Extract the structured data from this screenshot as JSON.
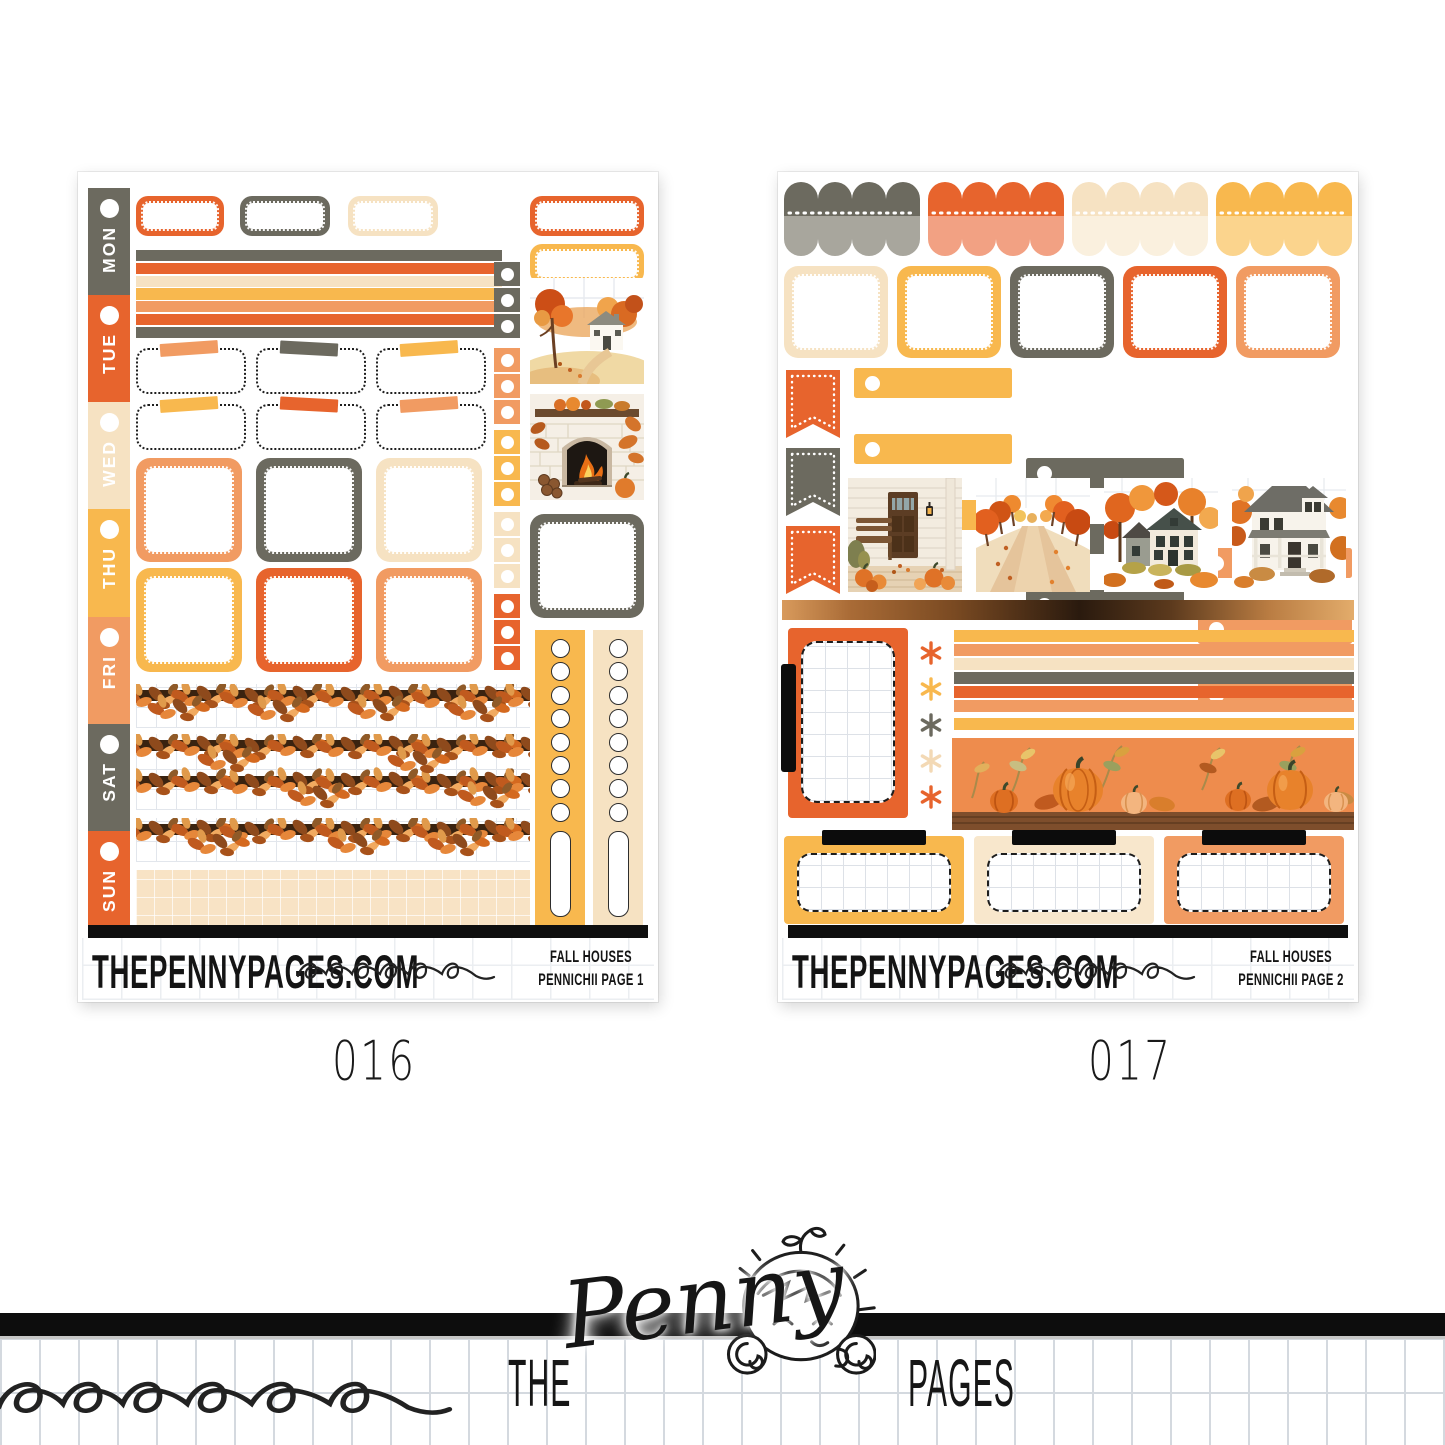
{
  "photo": {
    "background": "#ffffff"
  },
  "brand": {
    "site": "THEPENNYPAGES.COM",
    "kit_name": "FALL HOUSES",
    "logo_word_1": "THE",
    "logo_word_2": "Penny",
    "logo_word_3": "PAGES"
  },
  "sheets": [
    {
      "code": "016",
      "site": "THEPENNYPAGES.COM",
      "kit_line_1": "FALL HOUSES",
      "kit_line_2": "PENNICHII PAGE 1",
      "days": [
        "MON",
        "TUE",
        "WED",
        "THU",
        "FRI",
        "SAT",
        "SUN"
      ]
    },
    {
      "code": "017",
      "site": "THEPENNYPAGES.COM",
      "kit_line_1": "FALL HOUSES",
      "kit_line_2": "PENNICHII PAGE 2"
    }
  ],
  "palette": {
    "orange": "#E7642D",
    "salmon": "#F19B62",
    "salmon_light": "#F2A183",
    "cream": "#F6E2C2",
    "cream_light": "#FAEFDB",
    "yellow": "#F8B84E",
    "yellow_light": "#FBD48D",
    "gray": "#6C6A5F",
    "gray_light": "#A8A69D",
    "ink": "#111111",
    "copper": "#B97C42",
    "leaf_brown": "#3A2310"
  }
}
